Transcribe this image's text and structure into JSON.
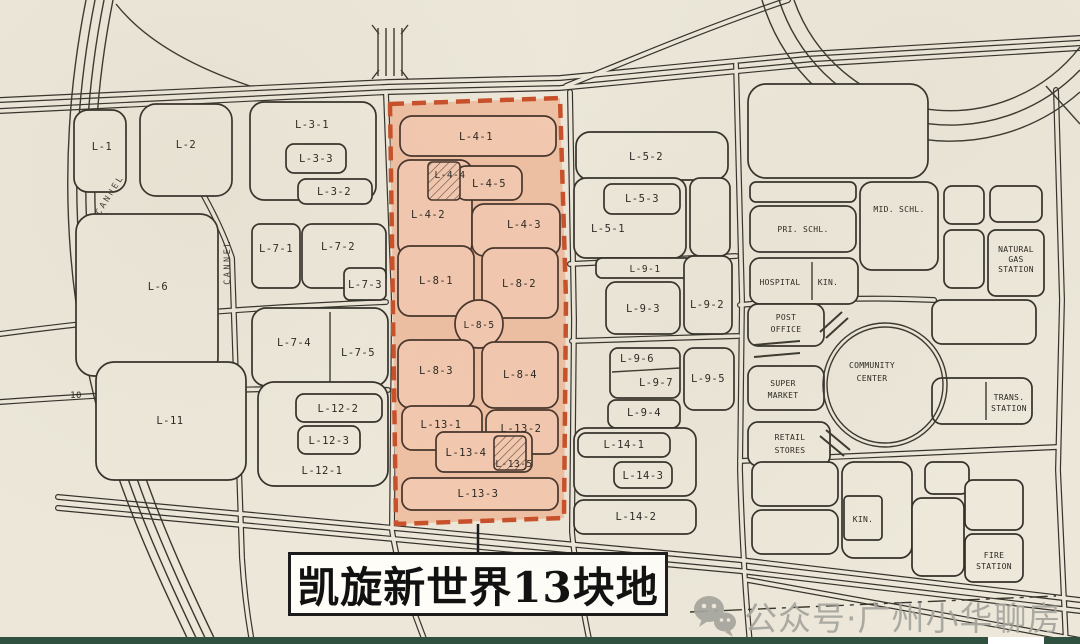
{
  "map": {
    "callout": {
      "label": "凯旋新世界13块地"
    },
    "watermark": {
      "icon": "wechat-chat-bubbles-icon",
      "text": "公众号·广州小华聊房"
    },
    "colors": {
      "paper": "#ece7d9",
      "line": "#35322c",
      "highlight_fill": "#eec0a4",
      "highlight_parcel_fill": "#f3c9b0",
      "highlight_border": "#c8502a",
      "bottom_bar": "#305040",
      "watermark_gray": "#a6a59e"
    },
    "canal_labels": [
      {
        "text": "CANNEL",
        "x": 112,
        "y": 196,
        "rotate": -58
      },
      {
        "text": "CANNEL",
        "x": 230,
        "y": 262,
        "rotate": -90
      }
    ],
    "parcel_labels": [
      {
        "text": "L-1",
        "x": 102,
        "y": 150
      },
      {
        "text": "L-2",
        "x": 186,
        "y": 148
      },
      {
        "text": "L-3-1",
        "x": 312,
        "y": 128
      },
      {
        "text": "L-3-3",
        "x": 316,
        "y": 162
      },
      {
        "text": "L-3-2",
        "x": 334,
        "y": 195
      },
      {
        "text": "L-6",
        "x": 158,
        "y": 290
      },
      {
        "text": "L-7-1",
        "x": 276,
        "y": 252
      },
      {
        "text": "L-7-2",
        "x": 338,
        "y": 250
      },
      {
        "text": "L-7-3",
        "x": 365,
        "y": 288
      },
      {
        "text": "L-7-4",
        "x": 294,
        "y": 346
      },
      {
        "text": "L-7-5",
        "x": 358,
        "y": 356
      },
      {
        "text": "L-11",
        "x": 170,
        "y": 424
      },
      {
        "text": "L-12-2",
        "x": 338,
        "y": 412
      },
      {
        "text": "L-12-3",
        "x": 329,
        "y": 444
      },
      {
        "text": "L-12-1",
        "x": 322,
        "y": 474
      },
      {
        "text": "10",
        "x": 76,
        "y": 398,
        "size": 9
      },
      {
        "text": "L-4-1",
        "x": 476,
        "y": 140,
        "highlighted": true
      },
      {
        "text": "L-4-4",
        "x": 450,
        "y": 178,
        "highlighted": true,
        "size": 9.5
      },
      {
        "text": "L-4-5",
        "x": 489,
        "y": 187,
        "highlighted": true
      },
      {
        "text": "L-4-2",
        "x": 428,
        "y": 218,
        "highlighted": true
      },
      {
        "text": "L-4-3",
        "x": 524,
        "y": 228,
        "highlighted": true
      },
      {
        "text": "L-8-1",
        "x": 436,
        "y": 284,
        "highlighted": true
      },
      {
        "text": "L-8-2",
        "x": 519,
        "y": 287,
        "highlighted": true
      },
      {
        "text": "L-8-5",
        "x": 479,
        "y": 328,
        "highlighted": true,
        "size": 9.5
      },
      {
        "text": "L-8-3",
        "x": 436,
        "y": 374,
        "highlighted": true
      },
      {
        "text": "L-8-4",
        "x": 520,
        "y": 378,
        "highlighted": true
      },
      {
        "text": "L-13-1",
        "x": 441,
        "y": 428,
        "highlighted": true
      },
      {
        "text": "L-13-2",
        "x": 521,
        "y": 432,
        "highlighted": true
      },
      {
        "text": "L-13-4",
        "x": 466,
        "y": 456,
        "highlighted": true
      },
      {
        "text": "L-13-5",
        "x": 514,
        "y": 467,
        "highlighted": true,
        "size": 9.5
      },
      {
        "text": "L-13-3",
        "x": 478,
        "y": 497,
        "highlighted": true
      },
      {
        "text": "L-5-2",
        "x": 646,
        "y": 160
      },
      {
        "text": "L-5-3",
        "x": 642,
        "y": 202
      },
      {
        "text": "L-5-1",
        "x": 608,
        "y": 232
      },
      {
        "text": "L-9-1",
        "x": 645,
        "y": 272,
        "size": 9.5
      },
      {
        "text": "L-9-3",
        "x": 643,
        "y": 312
      },
      {
        "text": "L-9-2",
        "x": 707,
        "y": 308
      },
      {
        "text": "L-9-6",
        "x": 637,
        "y": 362
      },
      {
        "text": "L-9-7",
        "x": 656,
        "y": 386
      },
      {
        "text": "L-9-5",
        "x": 708,
        "y": 382
      },
      {
        "text": "L-9-4",
        "x": 644,
        "y": 416
      },
      {
        "text": "L-14-1",
        "x": 624,
        "y": 448
      },
      {
        "text": "L-14-3",
        "x": 643,
        "y": 479
      },
      {
        "text": "L-14-2",
        "x": 636,
        "y": 520
      }
    ],
    "facility_labels": [
      {
        "lines": [
          "PRI. SCHL."
        ],
        "x": 803,
        "y": 232
      },
      {
        "lines": [
          "MID. SCHL."
        ],
        "x": 899,
        "y": 212
      },
      {
        "lines": [
          "HOSPITAL"
        ],
        "x": 780,
        "y": 285
      },
      {
        "lines": [
          "KIN."
        ],
        "x": 828,
        "y": 285
      },
      {
        "lines": [
          "NATURAL",
          "GAS",
          "STATION"
        ],
        "x": 1016,
        "y": 252,
        "lh": 10
      },
      {
        "lines": [
          "POST",
          "OFFICE"
        ],
        "x": 786,
        "y": 320,
        "lh": 12
      },
      {
        "lines": [
          "COMMUNITY",
          "CENTER"
        ],
        "x": 872,
        "y": 368,
        "lh": 13
      },
      {
        "lines": [
          "SUPER",
          "MARKET"
        ],
        "x": 783,
        "y": 386,
        "lh": 12
      },
      {
        "lines": [
          "RETAIL",
          "STORES"
        ],
        "x": 790,
        "y": 440,
        "lh": 13
      },
      {
        "lines": [
          "TRANS.",
          "STATION"
        ],
        "x": 1009,
        "y": 400,
        "lh": 11
      },
      {
        "lines": [
          "KIN."
        ],
        "x": 863,
        "y": 522
      },
      {
        "lines": [
          "FIRE",
          "STATION"
        ],
        "x": 994,
        "y": 558,
        "lh": 11
      }
    ]
  }
}
